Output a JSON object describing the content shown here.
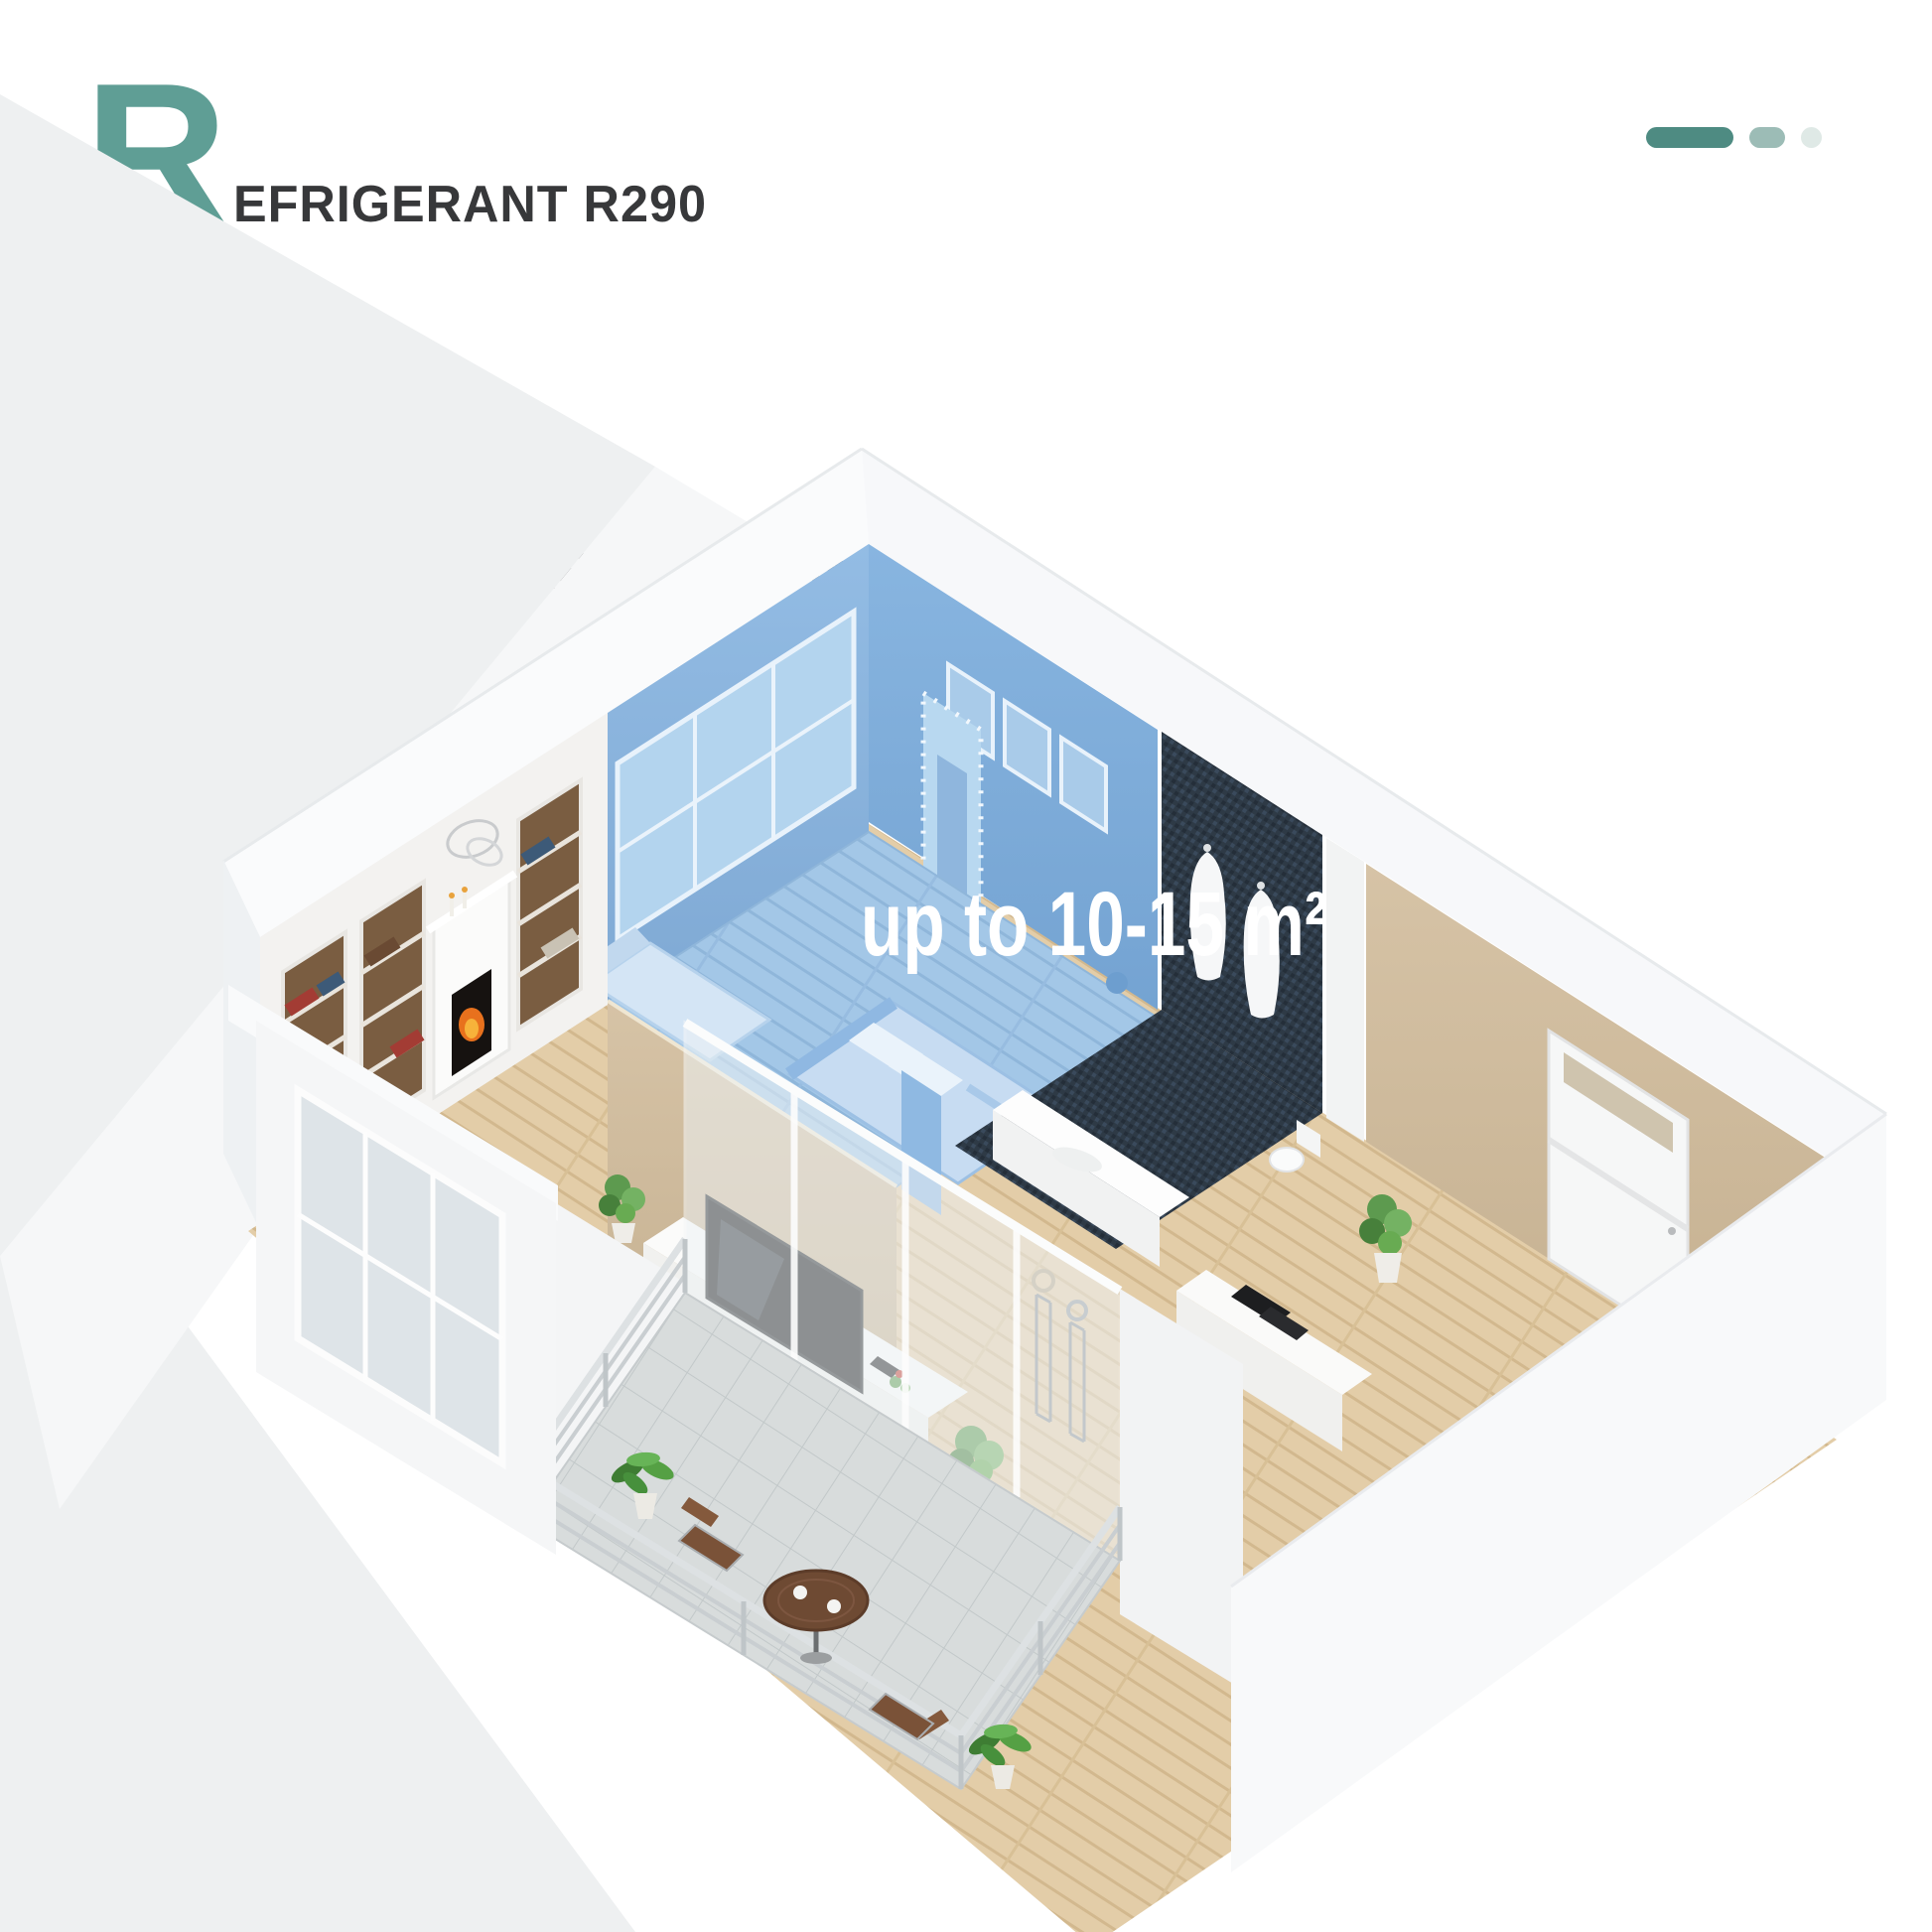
{
  "features": [
    {
      "initial": "R",
      "rest": "EFRIGERANT R290"
    },
    {
      "initial": "7",
      "rest": "000BTU"
    },
    {
      "initial": "F",
      "rest": "ITS ROOM AREA: 10-15 m²"
    }
  ],
  "floorplan": {
    "overlay_label": "up to 10-15 m²",
    "highlighted_room": "bedroom",
    "rooms": [
      "bedroom",
      "bathroom",
      "entry-hall",
      "living-room",
      "dining-area",
      "balcony"
    ]
  },
  "colors": {
    "accent_teal": "#5f9e95",
    "pill_dark": "#4e8b82",
    "pill_mid": "#9cbcb6",
    "pill_light": "#dfe9e6",
    "text_dark": "#37383a",
    "highlight_blue": "#7fb0dc",
    "overlay_text": "#ffffff",
    "bg_gray": "#eef0f1",
    "wood_floor": "#e3cda8",
    "beige_wall": "#cdb998",
    "dark_tile": "#2f3b47"
  }
}
